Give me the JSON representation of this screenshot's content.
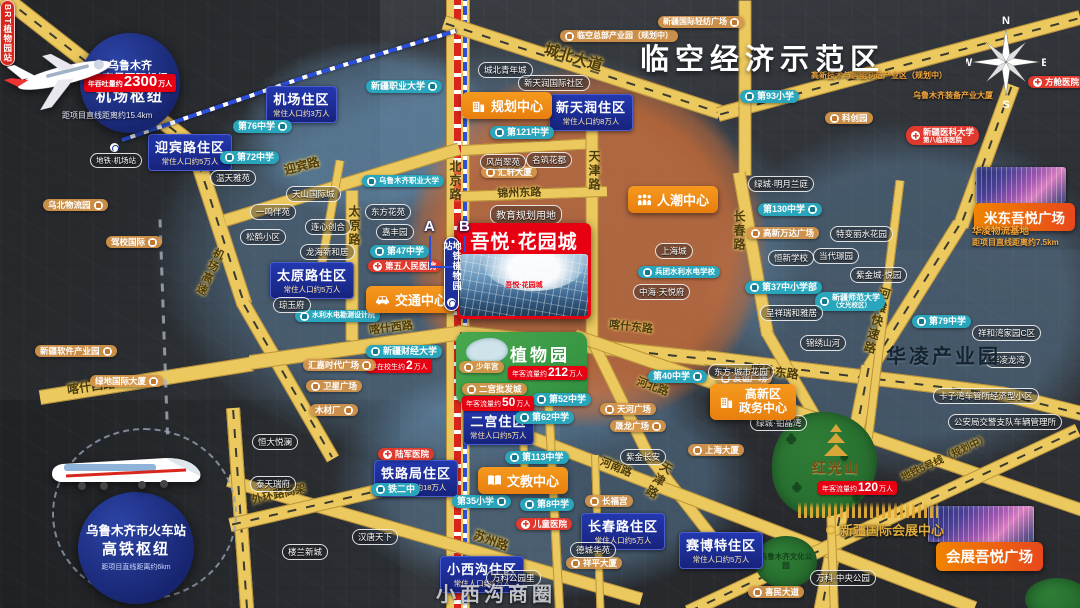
{
  "canvas": {
    "w": 1080,
    "h": 608
  },
  "colors": {
    "road": "#ecc95f",
    "road_border": "#b9923a",
    "district_blue": "#1d2f96",
    "teal": "#29a6bb",
    "hospital_red": "#e03a2f",
    "project_red": "#e60012",
    "center_orange": "#f08419",
    "brt_red": "#d8261c",
    "metro_blue": "#2b4fd8",
    "gold": "#e0ac3c",
    "overlay_blue": "#78aedc",
    "overlay_orange": "#f07020",
    "park_green": "#3f9a43"
  },
  "compass": {
    "n": "N",
    "e": "E",
    "s": "S",
    "w": "W"
  },
  "zones": {
    "airspace": "临空经济示范区",
    "hualing": "华凌产业园",
    "xiaoxigou": "小西沟商圈"
  },
  "project": {
    "name": "吾悦·花园城",
    "land_note": "教育规划用地"
  },
  "hubs": {
    "airport": {
      "l1": "乌鲁木齐",
      "l2": "地窝堡国际机场",
      "l3": "机场枢纽",
      "badge": {
        "pre": "年吞吐量约",
        "num": "2300",
        "suf": "万人"
      },
      "distance": "距项目直线距离约15.4km"
    },
    "railway": {
      "l1": "乌鲁木齐市火车站",
      "l2": "高铁枢纽",
      "distance": "距项目直线距离约6km"
    }
  },
  "transit": {
    "metro_station": "地铁植物园站",
    "brt_station": "BRT植物园站",
    "exit_a": "A",
    "exit_b": "B",
    "airport_metro": "地铁·机场站",
    "metro_segs": [
      {
        "x": 122,
        "y": 138,
        "len": 200,
        "rot": -19
      },
      {
        "x": 308,
        "y": 74,
        "len": 155,
        "rot": -17
      }
    ],
    "boundary_segs": [
      {
        "x": 160,
        "y": 218,
        "len": 215,
        "rot": 88
      }
    ]
  },
  "parks": {
    "botanical": {
      "name": "植物园",
      "badge": {
        "pre": "年客流量约",
        "num": "212",
        "suf": "万人"
      }
    },
    "hongguangshan": {
      "name": "红光山",
      "badge": {
        "pre": "年客流量约",
        "num": "120",
        "suf": "万人"
      }
    },
    "culture": "乌鲁木齐文化公园"
  },
  "malls": {
    "midong": "米东吾悦广场",
    "expo_plaza": "会展吾悦广场",
    "expo_center": "新疆国际会展中心",
    "hualing_logistics": {
      "name": "华凌物流基地",
      "distance": "距项目直线距离约7.5km"
    }
  },
  "centers": [
    {
      "label": "规划中心",
      "icon": "building",
      "x": 462,
      "y": 92
    },
    {
      "label": "人潮中心",
      "icon": "people",
      "x": 628,
      "y": 186
    },
    {
      "label": "交通中心",
      "icon": "car",
      "x": 366,
      "y": 286
    },
    {
      "label": "文教中心",
      "icon": "book",
      "x": 478,
      "y": 467
    },
    {
      "lines": [
        "高新区",
        "政务中心"
      ],
      "icon": "building",
      "x": 710,
      "y": 384,
      "fs": 12
    }
  ],
  "districts": [
    {
      "name": "机场住区",
      "pop": "常住人口约3万人",
      "x": 266,
      "y": 86
    },
    {
      "name": "迎宾路住区",
      "pop": "常住人口约5万人",
      "x": 148,
      "y": 134
    },
    {
      "name": "新天润住区",
      "pop": "常住人口约8万人",
      "x": 549,
      "y": 94
    },
    {
      "name": "太原路住区",
      "pop": "常住人口约5万人",
      "x": 270,
      "y": 262
    },
    {
      "name": "二宫住区",
      "pop": "常住人口约5万人",
      "x": 463,
      "y": 408
    },
    {
      "name": "铁路局住区",
      "pop": "常住人口约18万人",
      "x": 374,
      "y": 460
    },
    {
      "name": "小西沟住区",
      "pop": "常住人口约5万人",
      "x": 440,
      "y": 556
    },
    {
      "name": "长春路住区",
      "pop": "常住人口约5万人",
      "x": 581,
      "y": 513
    },
    {
      "name": "赛博特住区",
      "pop": "常住人口约5万人",
      "x": 679,
      "y": 532
    }
  ],
  "schools": [
    {
      "label": "第76中学",
      "x": 233,
      "y": 120,
      "side": "r"
    },
    {
      "label": "第72中学",
      "x": 220,
      "y": 151,
      "side": "l"
    },
    {
      "label": "新疆职业大学",
      "x": 366,
      "y": 80,
      "side": "r"
    },
    {
      "label": "乌鲁木齐职业大学",
      "x": 362,
      "y": 175,
      "side": "l",
      "fs": 7.5
    },
    {
      "label": "第47中学",
      "x": 370,
      "y": 245,
      "side": "l"
    },
    {
      "label": "第121中学",
      "x": 490,
      "y": 126,
      "side": "l"
    },
    {
      "label": "第93小学",
      "x": 740,
      "y": 90,
      "side": "l"
    },
    {
      "label": "第130中学",
      "x": 758,
      "y": 203,
      "side": "r"
    },
    {
      "label": "第37中小学部",
      "x": 745,
      "y": 281,
      "side": "l"
    },
    {
      "label": "新疆师范大学",
      "sub": "（文光校区）",
      "x": 815,
      "y": 292,
      "side": "l",
      "fs": 8
    },
    {
      "label": "兵团水利水电学校",
      "x": 638,
      "y": 266,
      "side": "l",
      "fs": 7.5
    },
    {
      "label": "水利水电勘测设计院",
      "x": 295,
      "y": 310,
      "side": "l",
      "fs": 7
    },
    {
      "label": "第79中学",
      "x": 912,
      "y": 315,
      "side": "l"
    },
    {
      "label": "第40中学",
      "x": 648,
      "y": 370,
      "side": "r"
    },
    {
      "label": "第52中学",
      "x": 532,
      "y": 393,
      "side": "l"
    },
    {
      "label": "第62中学",
      "x": 515,
      "y": 411,
      "side": "l"
    },
    {
      "label": "第113中学",
      "x": 505,
      "y": 451,
      "side": "l"
    },
    {
      "label": "第8中学",
      "x": 520,
      "y": 498,
      "side": "l"
    },
    {
      "label": "第35小学",
      "x": 452,
      "y": 495,
      "side": "r"
    },
    {
      "label": "铁二中",
      "x": 371,
      "y": 483,
      "side": "l"
    },
    {
      "label": "新疆财经大学",
      "x": 366,
      "y": 345,
      "side": "l",
      "badge": {
        "pre": "年在校生约",
        "num": "2",
        "suf": "万人"
      }
    }
  ],
  "hospitals": [
    {
      "label": "第五人民医院",
      "x": 368,
      "y": 260
    },
    {
      "label": "方舱医院",
      "x": 1028,
      "y": 76
    },
    {
      "label": "新疆医科大学",
      "sub": "第八临床医院",
      "x": 906,
      "y": 126
    },
    {
      "label": "儿童医院",
      "x": 516,
      "y": 518
    },
    {
      "label": "陆军医院",
      "x": 378,
      "y": 448
    }
  ],
  "pois": [
    {
      "label": "乌北物流园",
      "x": 43,
      "y": 199,
      "side": "r"
    },
    {
      "label": "驾校国际",
      "x": 106,
      "y": 236,
      "side": "r"
    },
    {
      "label": "新疆软件产业园",
      "x": 35,
      "y": 345,
      "side": "r"
    },
    {
      "label": "绿地国际大厦",
      "x": 90,
      "y": 375,
      "side": "r"
    },
    {
      "label": "汇嘉时代广场",
      "x": 303,
      "y": 359,
      "side": "r"
    },
    {
      "label": "卫星广场",
      "x": 306,
      "y": 380,
      "side": "l"
    },
    {
      "label": "木材厂",
      "x": 310,
      "y": 404,
      "side": "r"
    },
    {
      "label": "汇轩大厦",
      "x": 481,
      "y": 166,
      "side": "l"
    },
    {
      "label": "临空总部产业园（规划中）",
      "x": 560,
      "y": 30,
      "side": "l",
      "fs": 8
    },
    {
      "label": "新疆国际轻纺广场",
      "x": 658,
      "y": 16,
      "side": "r",
      "fs": 8
    },
    {
      "label": "高新技术与智能制造产业区（规划中）",
      "x": 806,
      "y": 70,
      "side": "l",
      "fs": 8,
      "textonly": true
    },
    {
      "label": "科创园",
      "x": 825,
      "y": 112,
      "side": "l"
    },
    {
      "label": "乌鲁木齐装备产业大厦",
      "x": 908,
      "y": 90,
      "side": "l",
      "fs": 8,
      "textonly": true
    },
    {
      "label": "高新万达广场",
      "x": 746,
      "y": 227,
      "side": "l"
    },
    {
      "label": "长福宫",
      "x": 585,
      "y": 495,
      "side": "l"
    },
    {
      "label": "祥平大厦",
      "x": 566,
      "y": 557,
      "side": "l"
    },
    {
      "label": "天河广场",
      "x": 600,
      "y": 403,
      "side": "l"
    },
    {
      "label": "晟龙广场",
      "x": 610,
      "y": 420,
      "side": "r"
    },
    {
      "label": "友谊广场",
      "x": 716,
      "y": 372,
      "side": "l"
    },
    {
      "label": "上海大厦",
      "x": 688,
      "y": 444,
      "side": "l"
    },
    {
      "label": "少年宫",
      "x": 459,
      "y": 361,
      "side": "l",
      "fs": 7.5
    },
    {
      "label": "喜民大道",
      "x": 748,
      "y": 586,
      "side": "l"
    },
    {
      "label": "二宫批发城",
      "x": 462,
      "y": 383,
      "side": "l",
      "badge": {
        "pre": "年客流量约",
        "num": "50",
        "suf": "万人"
      }
    }
  ],
  "estates": [
    {
      "label": "温天雅苑",
      "x": 210,
      "y": 170
    },
    {
      "label": "天山国际城",
      "x": 286,
      "y": 186
    },
    {
      "label": "一鸣伴苑",
      "x": 250,
      "y": 204
    },
    {
      "label": "松鹤小区",
      "x": 240,
      "y": 229
    },
    {
      "label": "连心创合",
      "x": 305,
      "y": 219
    },
    {
      "label": "龙海新和居",
      "x": 300,
      "y": 244
    },
    {
      "label": "琼玉府",
      "x": 273,
      "y": 297
    },
    {
      "label": "东方花苑",
      "x": 365,
      "y": 204
    },
    {
      "label": "嘉丰园",
      "x": 376,
      "y": 224
    },
    {
      "label": "城北青年城",
      "x": 478,
      "y": 62
    },
    {
      "label": "新天润国际社区",
      "x": 518,
      "y": 75
    },
    {
      "label": "风尚翠苑",
      "x": 480,
      "y": 154
    },
    {
      "label": "名筑花都",
      "x": 526,
      "y": 152
    },
    {
      "label": "上海城",
      "x": 655,
      "y": 243
    },
    {
      "label": "中海·天悦府",
      "x": 633,
      "y": 284
    },
    {
      "label": "绿城·明月兰庭",
      "x": 748,
      "y": 176
    },
    {
      "label": "特变丽水花园",
      "x": 830,
      "y": 226
    },
    {
      "label": "恒新学校",
      "x": 768,
      "y": 250
    },
    {
      "label": "当代璟园",
      "x": 813,
      "y": 248
    },
    {
      "label": "紫金城·悦园",
      "x": 850,
      "y": 267
    },
    {
      "label": "呈祥瑞和雅居",
      "x": 760,
      "y": 305
    },
    {
      "label": "锦绣山河",
      "x": 800,
      "y": 335
    },
    {
      "label": "祥和湾家园C区",
      "x": 972,
      "y": 325
    },
    {
      "label": "华凌龙湾",
      "x": 985,
      "y": 352
    },
    {
      "label": "紫金长安",
      "x": 620,
      "y": 449
    },
    {
      "label": "德城华苑",
      "x": 570,
      "y": 542
    },
    {
      "label": "万科公园里",
      "x": 486,
      "y": 570
    },
    {
      "label": "汉唐天下",
      "x": 352,
      "y": 529
    },
    {
      "label": "东方·城市花园",
      "x": 708,
      "y": 364
    },
    {
      "label": "绿城·铂晶湾",
      "x": 750,
      "y": 415
    },
    {
      "label": "卡子湾车管所经济型小区",
      "x": 933,
      "y": 388
    },
    {
      "label": "公安局交警支队车辆管理所",
      "x": 948,
      "y": 414
    },
    {
      "label": "万科·中央公园",
      "x": 810,
      "y": 570
    },
    {
      "label": "恒大悦澜",
      "x": 252,
      "y": 434
    },
    {
      "label": "泰天瑞府",
      "x": 250,
      "y": 476
    },
    {
      "label": "楼兰新城",
      "x": 282,
      "y": 544
    }
  ],
  "roads": [
    {
      "x": 458,
      "y": -8,
      "len": 630,
      "w": 24,
      "rot": 90,
      "stripes": [
        "metro",
        "brt"
      ]
    },
    {
      "x": 444,
      "y": 22,
      "len": 290,
      "w": 15,
      "rot": 18,
      "dash": true
    },
    {
      "x": 718,
      "y": 114,
      "len": 375,
      "w": 15,
      "rot": -15,
      "dash": true
    },
    {
      "x": -12,
      "y": -15,
      "len": 260,
      "w": 16,
      "rot": 38,
      "dash": true
    },
    {
      "x": 192,
      "y": 143,
      "len": 170,
      "w": 16,
      "rot": 72,
      "dash": true
    },
    {
      "x": 243,
      "y": 303,
      "len": 180,
      "w": 14,
      "rot": 60,
      "dash": true
    },
    {
      "x": 225,
      "y": 220,
      "len": 245,
      "w": 13,
      "rot": -17
    },
    {
      "x": 462,
      "y": 150,
      "len": 130,
      "w": 11,
      "rot": -3
    },
    {
      "x": 352,
      "y": 190,
      "len": 150,
      "w": 13,
      "rot": 90
    },
    {
      "x": 40,
      "y": 397,
      "len": 215,
      "w": 15,
      "rot": -9
    },
    {
      "x": 250,
      "y": 362,
      "len": 212,
      "w": 15,
      "rot": -8
    },
    {
      "x": 458,
      "y": 332,
      "len": 250,
      "w": 15,
      "rot": 6,
      "dash": true
    },
    {
      "x": 705,
      "y": 357,
      "len": 300,
      "w": 15,
      "rot": 7,
      "dash": true
    },
    {
      "x": 1001,
      "y": 393,
      "len": 95,
      "w": 15,
      "rot": 14,
      "dash": true
    },
    {
      "x": 592,
      "y": 118,
      "len": 225,
      "w": 13,
      "rot": 90
    },
    {
      "x": 592,
      "y": 340,
      "len": 130,
      "w": 12,
      "rot": 64
    },
    {
      "x": 648,
      "y": 455,
      "len": 130,
      "w": 12,
      "rot": 52
    },
    {
      "x": 462,
      "y": 196,
      "len": 145,
      "w": 11,
      "rot": -2
    },
    {
      "x": 745,
      "y": 0,
      "len": 175,
      "w": 13,
      "rot": 90
    },
    {
      "x": 739,
      "y": 172,
      "len": 165,
      "w": 13,
      "rot": 80
    },
    {
      "x": 767,
      "y": 333,
      "len": 120,
      "w": 12,
      "rot": 60
    },
    {
      "x": 1012,
      "y": 85,
      "len": 150,
      "w": 16,
      "rot": 110,
      "dash": true
    },
    {
      "x": 960,
      "y": 224,
      "len": 170,
      "w": 16,
      "rot": 122,
      "dash": true
    },
    {
      "x": 869,
      "y": 366,
      "len": 260,
      "w": 16,
      "rot": 101,
      "dash": true
    },
    {
      "x": 575,
      "y": 335,
      "len": 540,
      "w": 13,
      "rot": 19
    },
    {
      "x": 508,
      "y": 428,
      "len": 500,
      "w": 13,
      "rot": 21
    },
    {
      "x": 228,
      "y": 480,
      "len": 430,
      "w": 13,
      "rot": 16
    },
    {
      "x": 233,
      "y": 408,
      "len": 210,
      "w": 14,
      "rot": 86,
      "dash": true
    },
    {
      "x": 230,
      "y": 525,
      "len": 210,
      "w": 14,
      "rot": -13,
      "dash": true
    },
    {
      "x": 688,
      "y": 612,
      "len": 430,
      "w": 14,
      "rot": -25,
      "dash": true
    },
    {
      "x": 548,
      "y": 390,
      "len": 230,
      "w": 9,
      "rot": 87
    },
    {
      "x": 520,
      "y": 340,
      "len": 150,
      "w": 8,
      "rot": 88
    },
    {
      "x": 828,
      "y": 430,
      "len": 190,
      "w": 9,
      "rot": 88
    },
    {
      "x": 900,
      "y": 180,
      "len": 260,
      "w": 9,
      "rot": 97
    },
    {
      "x": 340,
      "y": 160,
      "len": 120,
      "w": 9,
      "rot": 100
    },
    {
      "x": 595,
      "y": 455,
      "len": 160,
      "w": 8,
      "rot": 88
    }
  ],
  "road_labels": [
    {
      "text": "北京路",
      "x": 447,
      "y": 160,
      "vert": true,
      "fs": 12
    },
    {
      "text": "迎宾路",
      "x": 282,
      "y": 162,
      "rot": -15,
      "fs": 12
    },
    {
      "text": "机场高速",
      "x": 213,
      "y": 245,
      "vert": true,
      "rot": 25,
      "fs": 11
    },
    {
      "text": "太原路",
      "x": 346,
      "y": 205,
      "vert": true,
      "fs": 12
    },
    {
      "text": "城北大道",
      "x": 548,
      "y": 38,
      "rot": 17,
      "fs": 15
    },
    {
      "text": "锦州东路",
      "x": 497,
      "y": 185,
      "rot": -2,
      "fs": 11
    },
    {
      "text": "天津路",
      "x": 586,
      "y": 150,
      "vert": true,
      "fs": 12
    },
    {
      "text": "天津路",
      "x": 662,
      "y": 458,
      "vert": true,
      "rot": 30,
      "fs": 12
    },
    {
      "text": "喀什西路",
      "x": 66,
      "y": 381,
      "rot": -8,
      "fs": 12
    },
    {
      "text": "喀什西路",
      "x": 368,
      "y": 322,
      "rot": -7,
      "fs": 11
    },
    {
      "text": "喀什东路",
      "x": 610,
      "y": 316,
      "rot": 6,
      "fs": 11
    },
    {
      "text": "喀什东路",
      "x": 752,
      "y": 360,
      "rot": 7,
      "fs": 12
    },
    {
      "text": "长春路",
      "x": 731,
      "y": 210,
      "vert": true,
      "fs": 12
    },
    {
      "text": "河滩快速路",
      "x": 878,
      "y": 285,
      "vert": true,
      "rot": 15,
      "fs": 12
    },
    {
      "text": "河北路",
      "x": 640,
      "y": 373,
      "rot": 20,
      "fs": 11
    },
    {
      "text": "河南路",
      "x": 604,
      "y": 453,
      "rot": 22,
      "fs": 11
    },
    {
      "text": "苏州路",
      "x": 477,
      "y": 526,
      "rot": 20,
      "fs": 12
    },
    {
      "text": "外环路高架",
      "x": 250,
      "y": 492,
      "rot": -13,
      "fs": 11
    },
    {
      "text": "地铁5号线（规划中）",
      "x": 898,
      "y": 470,
      "rot": -25,
      "fs": 10
    }
  ]
}
